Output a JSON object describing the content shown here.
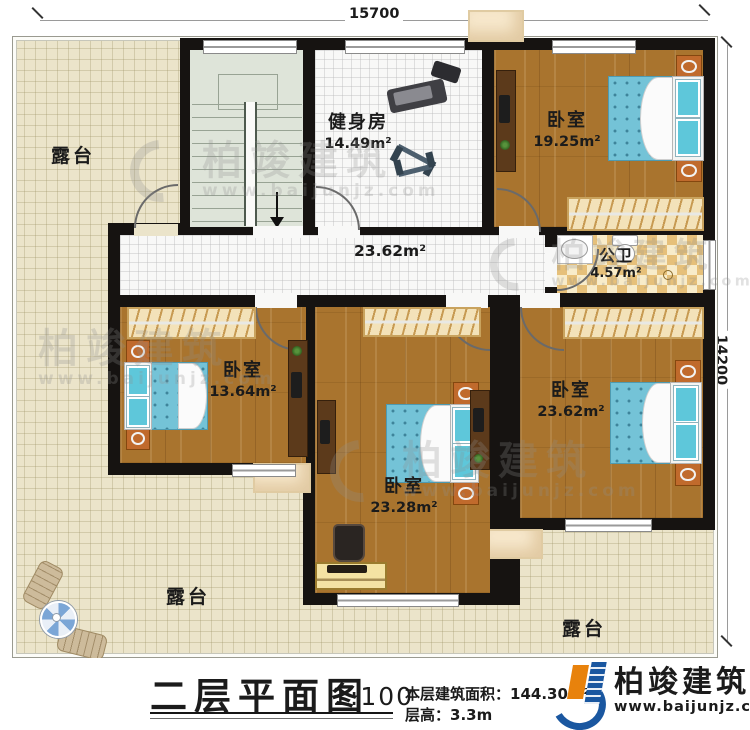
{
  "dimensions": {
    "top": "15700",
    "right": "14200"
  },
  "rooms": {
    "gym": {
      "name": "健身房",
      "area": "14.49m²"
    },
    "bedroom_top_right": {
      "name": "卧室",
      "area": "19.25m²"
    },
    "hall": {
      "area": "23.62m²"
    },
    "bathroom": {
      "name": "公卫",
      "area": "4.57m²"
    },
    "bedroom_left": {
      "name": "卧室",
      "area": "13.64m²"
    },
    "bedroom_middle": {
      "name": "卧室",
      "area": "23.28m²"
    },
    "bedroom_right": {
      "name": "卧室",
      "area": "23.62m²"
    }
  },
  "terraces": {
    "top_left": "露台",
    "bottom_left": "露台",
    "bottom_right": "露台"
  },
  "title_block": {
    "title": "二层平面图",
    "scale": "1:100",
    "area_label": "本层建筑面积：",
    "area_value": "144.30m²",
    "floor_height_label": "层高：",
    "floor_height_value": "3.3m"
  },
  "brand": {
    "name": "柏竣建筑",
    "website": "www.baijunjz.com"
  },
  "watermark": {
    "name": "柏竣建筑",
    "website": "www.baijunjz.com"
  },
  "colors": {
    "wall": "#161311",
    "wood_floor": "#a9742e",
    "terrace_floor": "#ebe4ca",
    "tile_floor": "#f8f8f7",
    "bathroom_tile": "#e6c07a",
    "bed_blue": "#74c3d7",
    "nightstand_orange": "#c06a2c",
    "brand_blue": "#1a57a0",
    "brand_orange": "#e8820c"
  }
}
